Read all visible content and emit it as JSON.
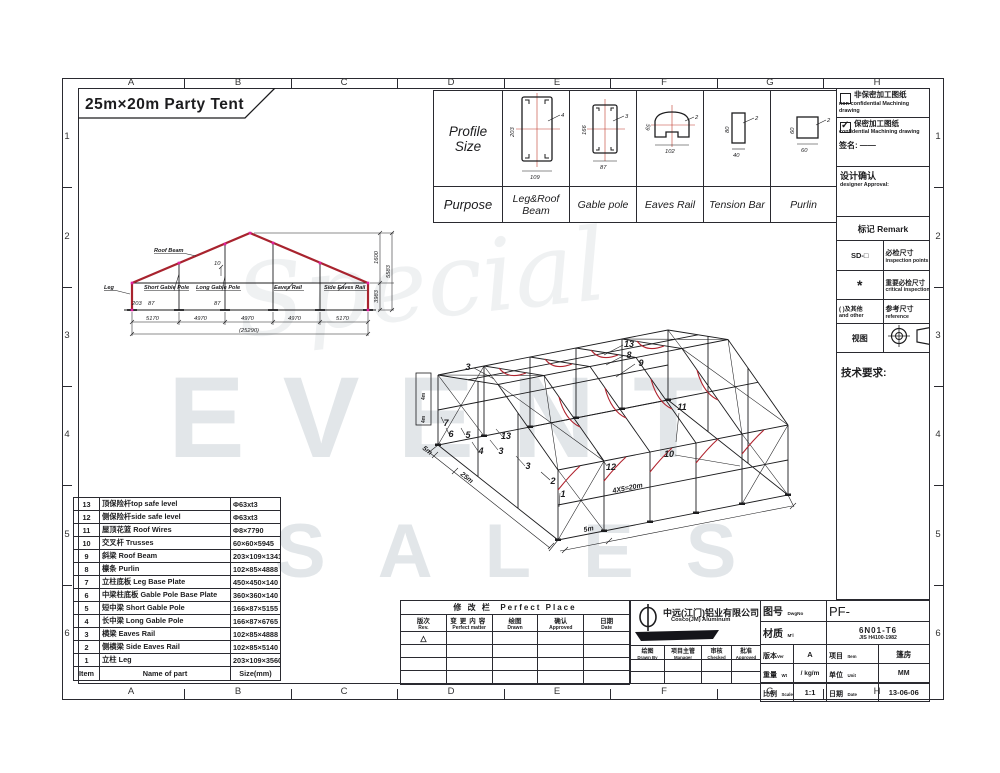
{
  "frame": {
    "cols": [
      "A",
      "B",
      "C",
      "D",
      "E",
      "F",
      "G",
      "H"
    ],
    "rows": [
      "1",
      "2",
      "3",
      "4",
      "5",
      "6"
    ]
  },
  "title": "25m×20m Party Tent",
  "watermark": {
    "script": "Special",
    "line1": "EVENT",
    "line2": "SALES"
  },
  "profile_table": {
    "row_label_1": "Profile",
    "row_label_2": "Size",
    "purpose_label": "Purpose",
    "columns": [
      {
        "purpose": "Leg&Roof Beam",
        "h": "203",
        "w": "109",
        "t": "4"
      },
      {
        "purpose": "Gable pole",
        "h": "166",
        "w": "87",
        "t": "3"
      },
      {
        "purpose": "Eaves Rail",
        "h": "65",
        "w": "102",
        "t": "2"
      },
      {
        "purpose": "Tension Bar",
        "h": "80",
        "w": "40",
        "t": "2"
      },
      {
        "purpose": "Purlin",
        "h": "60",
        "w": "60",
        "t": "2"
      }
    ]
  },
  "right_panel": {
    "check": "✓",
    "nonconf_cn": "非保密加工图纸",
    "nonconf_en": "non-confidential Machining drawing",
    "conf_cn": "保密加工图纸",
    "conf_en": "confidential Machining drawing",
    "signature_label": "签名:",
    "signature_line": "——",
    "design_cn": "设计确认",
    "design_en": "designer Approval:",
    "remark_header_cn": "标记",
    "remark_header_en": "Remark",
    "row1_sym": "SD-□",
    "row1_cn": "必检尺寸",
    "row1_en": "inspection points",
    "row2_sym": "*",
    "row2_cn": "重要必检尺寸",
    "row2_en": "critical inspection",
    "row3_sym_cn": "( )及其他",
    "row3_sym_en": "and other",
    "row3_cn": "参考尺寸",
    "row3_en": "reference",
    "row4_label": "视图",
    "tech_req": "技术要求:"
  },
  "elevation": {
    "labels": {
      "roof_beam": "Roof Beam",
      "leg": "Leg",
      "short_gable": "Short Gable Pole",
      "long_gable": "Long Gable Pole",
      "eaves_rail": "Eaves Rail",
      "side_eaves": "Side Eaves Rail"
    },
    "dims": {
      "bay1": "5170",
      "bay2": "4970",
      "bay3": "4970",
      "bay4": "4970",
      "bay5": "5170",
      "total": "(25290)",
      "leg_w": "203",
      "leg_d": "87",
      "pole_w": "87",
      "offset": "10",
      "rise": "1600",
      "eave_h": "3983",
      "ridge_h": "5583"
    }
  },
  "iso": {
    "labels": {
      "top3": "3",
      "top13": "13",
      "n8": "8",
      "n9": "9",
      "n11": "11",
      "n10": "10",
      "n12": "12",
      "n1": "1",
      "n2": "2",
      "n3a": "3",
      "n3b": "3",
      "n4": "4",
      "n5": "5",
      "n6": "6",
      "n7": "7",
      "n13b": "13"
    },
    "dims": {
      "bay": "5m",
      "bay2": "5m",
      "width": "25m",
      "length": "4X5=20m",
      "door_h": "4m",
      "door_h2": "4m"
    }
  },
  "bom": {
    "footer": {
      "item": "Item",
      "name": "Name of part",
      "size": "Size(mm)"
    },
    "rows": [
      {
        "no": "13",
        "name": "顶保险杆top safe level",
        "size": "Φ63xt3"
      },
      {
        "no": "12",
        "name": "侧保险杆side safe level",
        "size": "Φ63xt3"
      },
      {
        "no": "11",
        "name": "屋顶花篮 Roof Wires",
        "size": "Φ8×7790"
      },
      {
        "no": "10",
        "name": "交叉杆 Trusses",
        "size": "60×60×5945"
      },
      {
        "no": "9",
        "name": "斜梁 Roof Beam",
        "size": "203×109×13410"
      },
      {
        "no": "8",
        "name": "檩条 Purlin",
        "size": "102×85×4888"
      },
      {
        "no": "7",
        "name": "立柱底板 Leg Base Plate",
        "size": "450×450×140"
      },
      {
        "no": "6",
        "name": "中梁柱底板 Gable Pole Base Plate",
        "size": "360×360×140"
      },
      {
        "no": "5",
        "name": "短中梁 Short Gable Pole",
        "size": "166×87×5155"
      },
      {
        "no": "4",
        "name": "长中梁 Long Gable Pole",
        "size": "166×87×6765"
      },
      {
        "no": "3",
        "name": "横梁 Eaves Rail",
        "size": "102×85×4888"
      },
      {
        "no": "2",
        "name": "侧横梁 Side Eaves Rail",
        "size": "102×85×5140"
      },
      {
        "no": "1",
        "name": "立柱 Leg",
        "size": "203×109×3560"
      }
    ]
  },
  "revision": {
    "title_cn": "修 改 栏",
    "title_en": "Perfect Place",
    "col_rev_cn": "版次",
    "col_rev_en": "Rev.",
    "col_matter_cn": "变更内容",
    "col_matter_en": "Perfect matter",
    "col_drawn_cn": "绘图",
    "col_drawn_en": "Drawn",
    "col_appr_cn": "确认",
    "col_appr_en": "Approved",
    "col_date_cn": "日期",
    "col_date_en": "Date",
    "marker": "△"
  },
  "company": {
    "name_cn": "中远(江门)铝业有限公司",
    "name_en": "Cosco(JM) Aluminum",
    "drawn_cn": "绘图",
    "drawn_en": "Drawn By",
    "mgr_cn": "项目主管",
    "mgr_en": "Manager",
    "chk_cn": "审核",
    "chk_en": "Checked",
    "appr_cn": "批准",
    "appr_en": "Approved",
    "dwgno_cn": "图号",
    "dwgno_en": "DwgNo",
    "dwgno_val": "PF-",
    "mat_cn": "材质",
    "mat_en": "M'l",
    "mat_val": "6N01-T6",
    "mat_std": "JIS H4100-1982",
    "ver_cn": "版本",
    "ver_en": "Ver",
    "ver_val": "A",
    "item_cn": "项目",
    "item_en": "Item",
    "item_val": "篷房",
    "wt_cn": "重量",
    "wt_en": "Wt",
    "wt_val": "/ kg/m",
    "unit_cn": "单位",
    "unit_en": "Unit",
    "unit_val": "MM",
    "scale_cn": "比例",
    "scale_en": "Scale",
    "scale_val": "1:1",
    "date_cn": "日期",
    "date_en": "Date",
    "date_val": "13-06-06"
  }
}
